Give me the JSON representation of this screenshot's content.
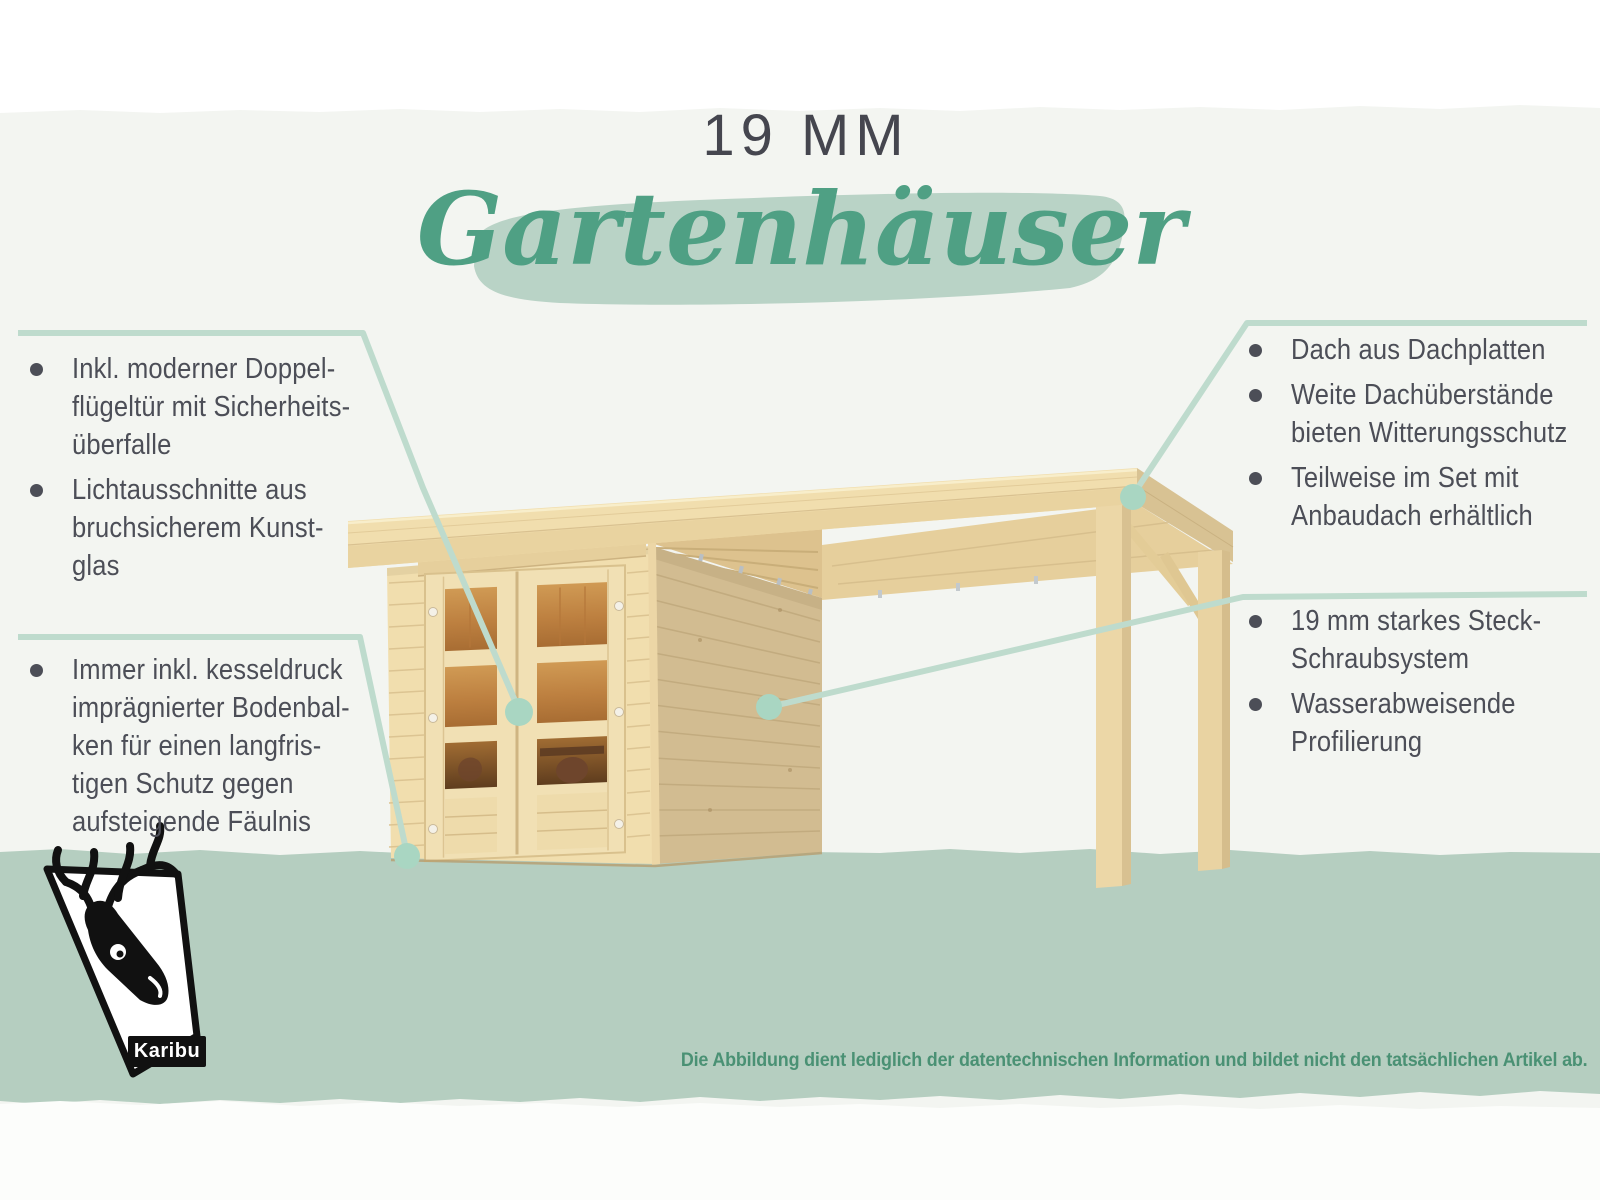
{
  "title": {
    "kicker": "19 MM",
    "script": "Gartenhäuser"
  },
  "callouts": {
    "left_top": {
      "items": [
        "Inkl. moderner Doppel-\nflügeltür mit Sicherheits-\nüberfalle",
        "Lichtausschnitte aus\nbruchsicherem Kunst-\nglas"
      ]
    },
    "left_bottom": {
      "items": [
        "Immer inkl. kesseldruck\nimprägnierter Bodenbal-\nken für einen langfris-\ntigen Schutz gegen\naufsteigende Fäulnis"
      ]
    },
    "right_top": {
      "items": [
        "Dach aus Dachplatten",
        "Weite Dachüberstände\nbieten Witterungsschutz",
        "Teilweise im Set mit\nAnbaudach erhältlich"
      ]
    },
    "right_bottom": {
      "items": [
        "19 mm starkes Steck-\nSchraubsystem",
        "Wasserabweisende\nProfilierung"
      ]
    }
  },
  "disclaimer": "Die Abbildung dient lediglich der datentechnischen Information und bildet nicht den tatsächlichen Artikel ab.",
  "logo": {
    "label": "Karibu"
  },
  "icons": {
    "logo_icon": "deer-head-icon"
  },
  "colors": {
    "background": "#f3f5f1",
    "top_strip": "#ffffff",
    "bottom_strip": "#fcfdfb",
    "ground_band": "#b5cec0",
    "title_color": "#45464f",
    "text_color": "#4c4e57",
    "script_color": "#4fa084",
    "brush_color": "#b9d3c6",
    "disclaimer_color": "#4a9174",
    "callout_line": "#bedbcd",
    "callout_dot": "#a9d6c2",
    "wood_light": "#f1deae",
    "wood_fascia": "#e9d3a0",
    "wood_side": "#d2bc91",
    "wood_edge": "#d8c293",
    "glass_amber": "#c08142",
    "logo_black": "#111111"
  }
}
